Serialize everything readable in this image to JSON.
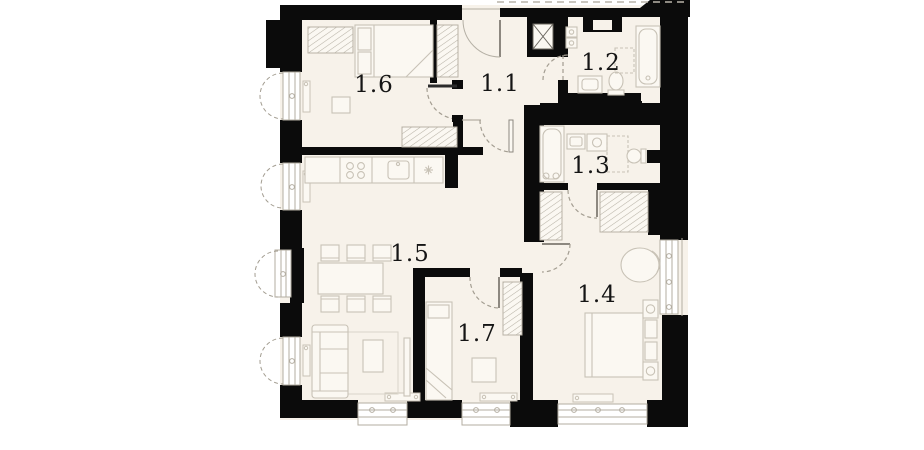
{
  "plan": {
    "type": "apartment-floor-plan",
    "rooms": [
      {
        "label": "1.1",
        "name": "hallway"
      },
      {
        "label": "1.2",
        "name": "bathroom"
      },
      {
        "label": "1.3",
        "name": "bathroom-2"
      },
      {
        "label": "1.4",
        "name": "bedroom"
      },
      {
        "label": "1.5",
        "name": "kitchen-living-room"
      },
      {
        "label": "1.6",
        "name": "bedroom-2"
      },
      {
        "label": "1.7",
        "name": "room"
      }
    ],
    "colors": {
      "wall": "#0b0b0b",
      "floor": "#f7f2ea",
      "furniture_stroke": "#c8c2b6",
      "furniture_fill": "#fbf8f2",
      "hatch": "#b8b2a6",
      "door_arc": "#a39d91",
      "label": "#151515",
      "background": "#ffffff"
    },
    "icons": [
      "bed-icon",
      "sofa-icon",
      "dining-table-icon",
      "chair-icon",
      "stove-icon",
      "kitchen-sink-icon",
      "bathtub-icon",
      "toilet-icon",
      "sink-icon",
      "washing-machine-icon",
      "wardrobe-icon",
      "armchair-icon",
      "radiator-icon",
      "window-icon",
      "door-swing-icon",
      "ventilation-shaft-icon",
      "desk-icon",
      "coffee-table-icon",
      "nightstand-icon"
    ]
  }
}
